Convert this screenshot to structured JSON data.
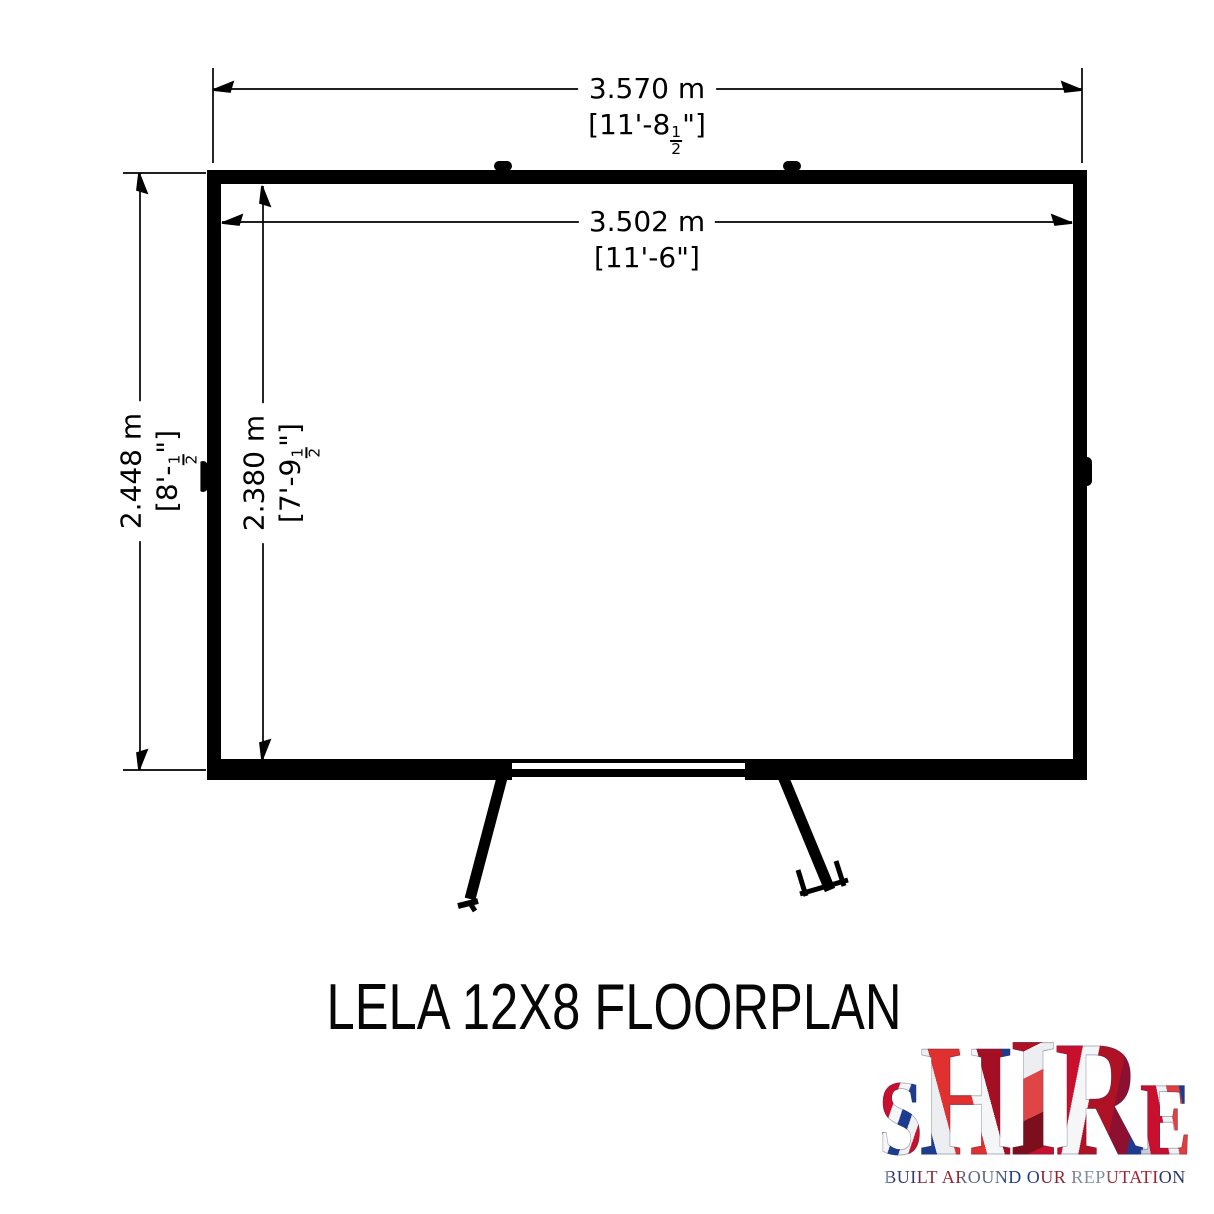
{
  "floorplan": {
    "title": "LELA 12X8 FLOORPLAN",
    "dimensions": {
      "outer_width": {
        "metric": "3.570 m",
        "imperial": "[11'-8½\"]"
      },
      "inner_width": {
        "metric": "3.502 m",
        "imperial": "[11'-6\"]"
      },
      "outer_depth": {
        "metric": "2.448 m",
        "imperial": "[8'-½\"]"
      },
      "inner_depth": {
        "metric": "2.380 m",
        "imperial": "[7'-9½\"]"
      }
    }
  },
  "brand": {
    "name_letters": [
      "S",
      "H",
      "I",
      "R",
      "E"
    ],
    "tagline": "BUILT AROUND OUR REPUTATION",
    "colors": {
      "flag_red": "#C8102E",
      "flag_blue": "#1D3C8F",
      "silver": "#C9CFD8"
    }
  }
}
